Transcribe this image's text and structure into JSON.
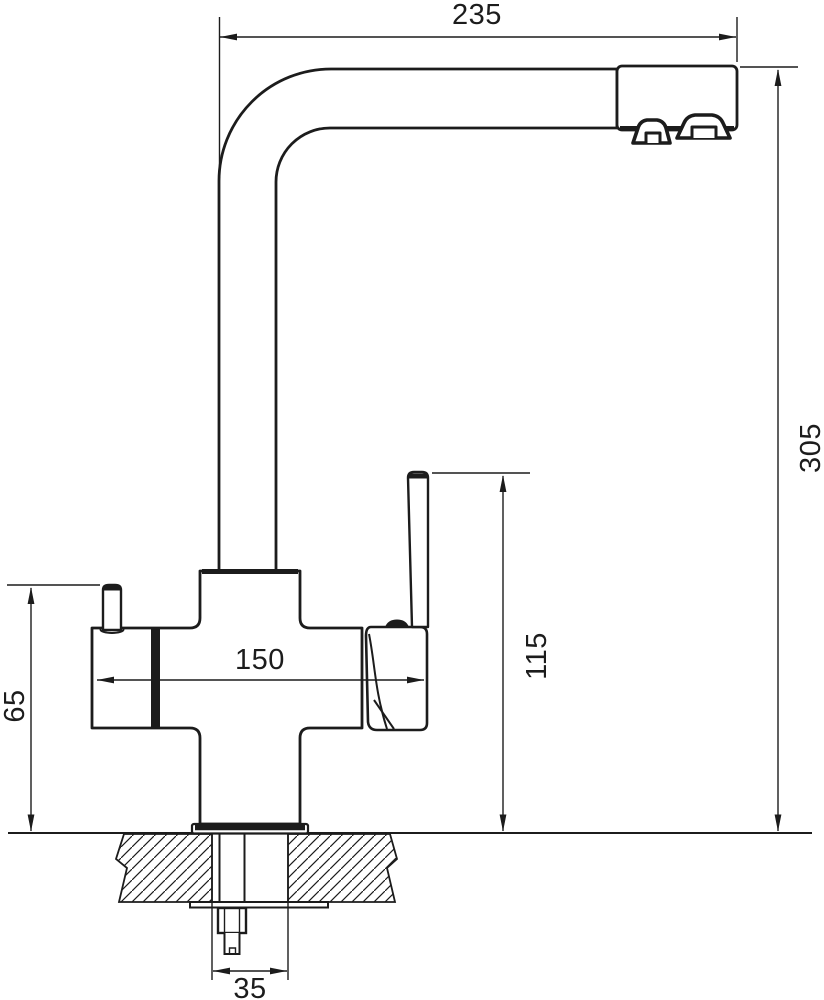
{
  "drawing": {
    "subject": "kitchen-faucet-side-view-technical-drawing",
    "dimensions": {
      "spout_reach": "235",
      "overall_height": "305",
      "body_width": "150",
      "lever_top_height": "115",
      "side_handle_height": "65",
      "mounting_stem": "35"
    },
    "colors": {
      "line": "#1c1c1c",
      "background": "#ffffff"
    }
  }
}
